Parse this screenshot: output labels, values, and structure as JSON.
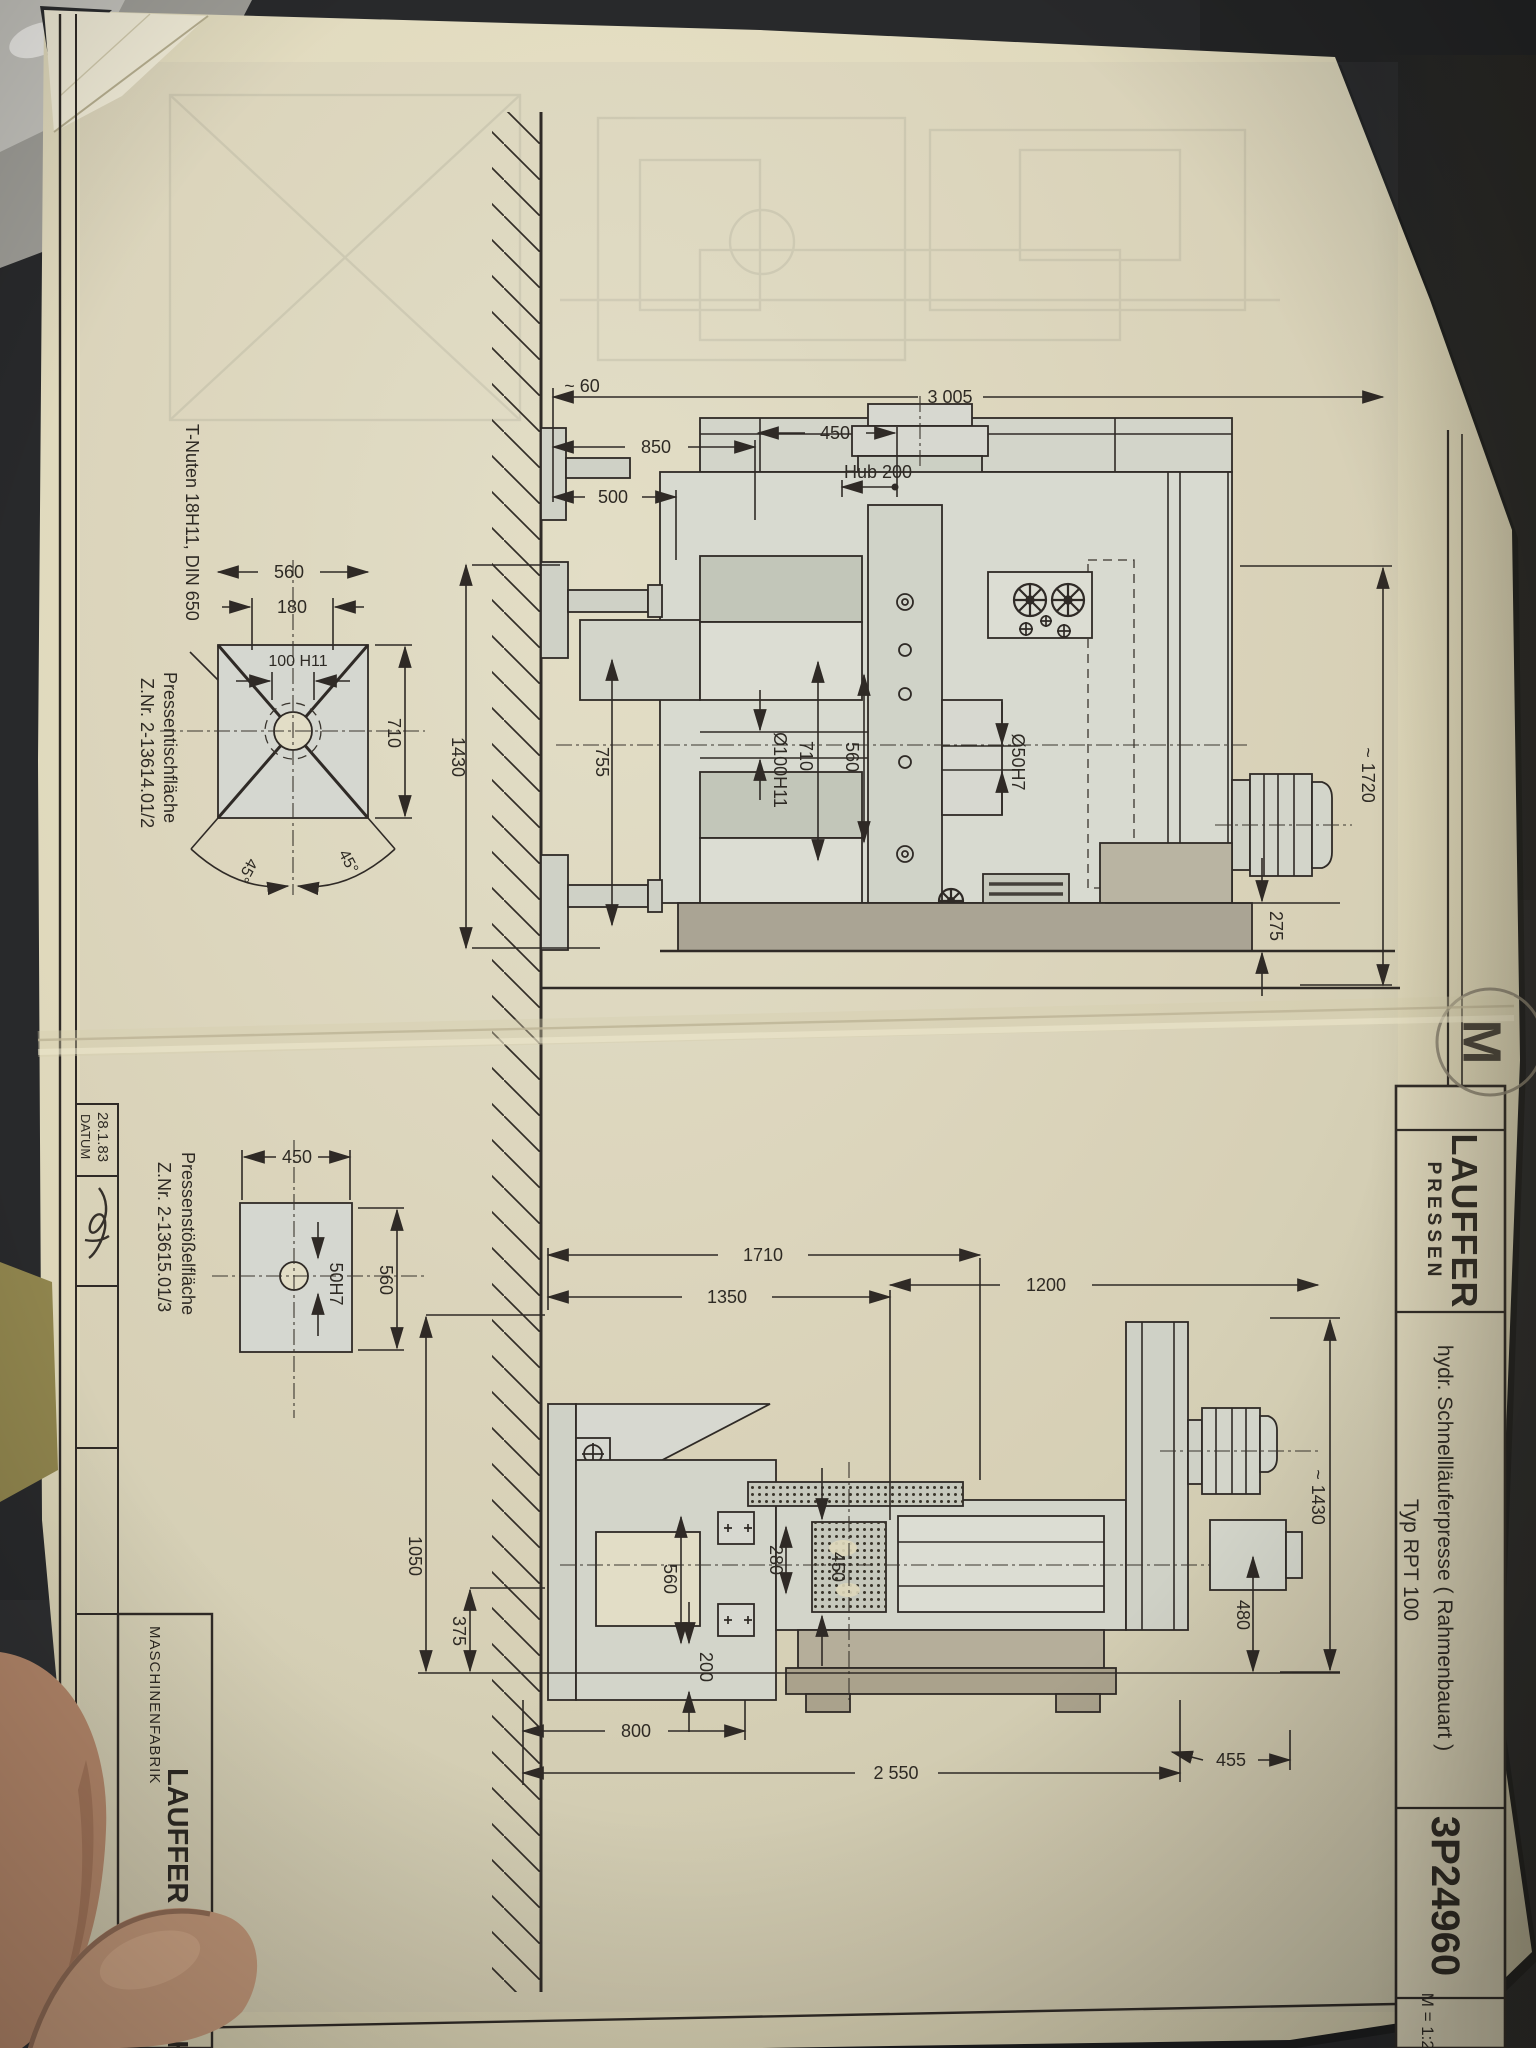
{
  "photo": {
    "background_color": "#28292b",
    "paper_color": "#ded7ba",
    "ink_color": "#2f2a26",
    "stamp_color": "#857e6e"
  },
  "title_block": {
    "logo_line1": "LAUFFER",
    "logo_line2": "PRESSEN",
    "title_line1": "hydr. Schnellläuferpresse ( Rahmenbauart )",
    "title_line2": "Typ RPT 100",
    "drawing_number": "3P24960",
    "scale": "M = 1:20",
    "stamp_letter": "M"
  },
  "left_block": {
    "date": "28.1.83",
    "date_label": "DATUM",
    "maker_prefix": "MASCHINENFABRIK",
    "maker_name": "LAUFFER & BUTSCHER"
  },
  "annotations": {
    "t_slots": "T-Nuten 18H11, DIN 650",
    "table_face_line1": "Pressentischfläche",
    "table_face_line2": "Z.Nr. 2-13614.01/2",
    "ram_face_line1": "Pressenstößelfläche",
    "ram_face_line2": "Z.Nr. 2-13615.01/3"
  },
  "dims_upper": {
    "wall_gap": "~ 60",
    "total": "3 005",
    "d850": "850",
    "d450": "450",
    "hub": "Hub 200",
    "d500": "500",
    "d1430": "1430",
    "d755": "755",
    "bore100": "Ø100H11",
    "d710": "710",
    "d560": "560",
    "bore50": "Ø50H7",
    "height1720": "~ 1720",
    "d275": "275"
  },
  "dims_table_detail": {
    "d560": "560",
    "d180": "180",
    "slot100": "100 H11",
    "d710": "710",
    "angle_left": "45°",
    "angle_right": "45°"
  },
  "dims_ram_detail": {
    "d450": "450",
    "d560": "560",
    "bore50": "50H7"
  },
  "dims_lower": {
    "d1710": "1710",
    "d1350": "1350",
    "d1200": "1200",
    "h1430": "~ 1430",
    "d1050": "1050",
    "d375": "375",
    "d560": "560",
    "d280": "280",
    "d450": "450",
    "d200": "200",
    "d800": "800",
    "d2550": "2 550",
    "d455": "455",
    "d480": "480"
  }
}
